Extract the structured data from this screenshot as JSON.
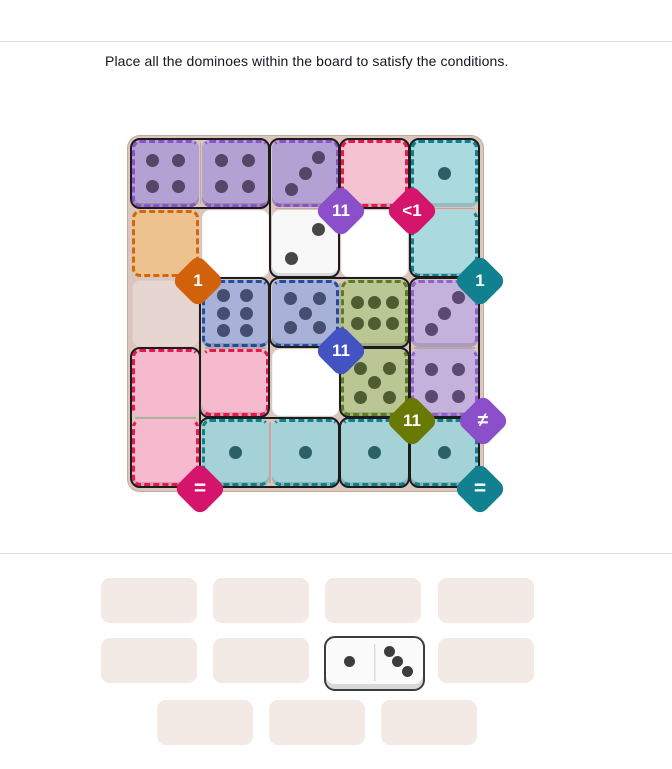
{
  "title": "Place all the dominoes within the board to satisfy the conditions.",
  "board": {
    "bg": "#dbc6bd",
    "metrics": {
      "off": 5,
      "pitch": 69.8,
      "size": 67
    },
    "cells": [
      {
        "id": "r1c1",
        "r": 1,
        "c": 1,
        "fill": "#b4a1d3",
        "pips": 4,
        "layout": "4",
        "pip": "#574568",
        "dash": "#8a52c8",
        "sides": "tlb",
        "lip": true
      },
      {
        "id": "r1c2",
        "r": 1,
        "c": 2,
        "fill": "#b4a1d3",
        "pips": 4,
        "layout": "4",
        "pip": "#574568",
        "dash": "#8a52c8",
        "sides": "tb",
        "lip": true
      },
      {
        "id": "r1c3",
        "r": 1,
        "c": 3,
        "fill": "#b4a1d3",
        "pips": 3,
        "layout": "3a",
        "pip": "#574568",
        "dash": "#8a52c8",
        "sides": "trb",
        "lip": true
      },
      {
        "id": "r1c4",
        "r": 1,
        "c": 4,
        "fill": "#f5c2d2",
        "pips": 0,
        "layout": "0",
        "pip": "",
        "dash": "#e8174f",
        "sides": "tlrb",
        "lip": true
      },
      {
        "id": "r1c5",
        "r": 1,
        "c": 5,
        "fill": "#aadade",
        "pips": 1,
        "layout": "1",
        "pip": "#2b6066",
        "dash": "#107f8d",
        "sides": "tlr",
        "lip": true
      },
      {
        "id": "r2c1",
        "r": 2,
        "c": 1,
        "fill": "#eec28f",
        "pips": 0,
        "layout": "0",
        "pip": "",
        "dash": "#d2660b",
        "sides": "tlrb",
        "lip": false
      },
      {
        "id": "r2c2",
        "r": 2,
        "c": 2,
        "fill": "#ffffff",
        "pips": 0,
        "layout": "0",
        "pip": "",
        "dash": null,
        "sides": "",
        "lip": false
      },
      {
        "id": "r2c3",
        "r": 2,
        "c": 3,
        "fill": "#f8f8f8",
        "pips": 2,
        "layout": "2",
        "pip": "#474747",
        "dash": null,
        "sides": "",
        "lip": true
      },
      {
        "id": "r2c4",
        "r": 2,
        "c": 4,
        "fill": "#ffffff",
        "pips": 0,
        "layout": "0",
        "pip": "",
        "dash": null,
        "sides": "",
        "lip": false
      },
      {
        "id": "r2c5",
        "r": 2,
        "c": 5,
        "fill": "#aadade",
        "pips": 0,
        "layout": "0",
        "pip": "",
        "dash": "#107f8d",
        "sides": "lrb",
        "lip": true
      },
      {
        "id": "r3c1",
        "r": 3,
        "c": 1,
        "fill": "#e6d5d1",
        "pips": 0,
        "layout": "0",
        "pip": "",
        "dash": null,
        "sides": "",
        "lip": false
      },
      {
        "id": "r3c2",
        "r": 3,
        "c": 2,
        "fill": "#a8b1d8",
        "pips": 6,
        "layout": "6v",
        "pip": "#434e70",
        "dash": "#1d4f9e",
        "sides": "tlb",
        "lip": true
      },
      {
        "id": "r3c3",
        "r": 3,
        "c": 3,
        "fill": "#a8b1d8",
        "pips": 5,
        "layout": "5",
        "pip": "#434e70",
        "dash": "#1d4f9e",
        "sides": "trb",
        "lip": true
      },
      {
        "id": "r3c4",
        "r": 3,
        "c": 4,
        "fill": "#bac795",
        "pips": 6,
        "layout": "6h",
        "pip": "#4e5d31",
        "dash": "#5d7c1d",
        "sides": "tlr",
        "lip": true
      },
      {
        "id": "r3c5",
        "r": 3,
        "c": 5,
        "fill": "#c4b2dd",
        "pips": 3,
        "layout": "3a",
        "pip": "#5c4870",
        "dash": "#9260cc",
        "sides": "tlr",
        "lip": true
      },
      {
        "id": "r4c1",
        "r": 4,
        "c": 1,
        "fill": "#f5bacd",
        "pips": 0,
        "layout": "0",
        "pip": "",
        "dash": "#e8174f",
        "sides": "tl",
        "lip": false
      },
      {
        "id": "r4c2",
        "r": 4,
        "c": 2,
        "fill": "#f5bacd",
        "pips": 0,
        "layout": "0",
        "pip": "",
        "dash": "#e8174f",
        "sides": "trb",
        "lip": true
      },
      {
        "id": "r4c3",
        "r": 4,
        "c": 3,
        "fill": "#ffffff",
        "pips": 0,
        "layout": "0",
        "pip": "",
        "dash": null,
        "sides": "",
        "lip": false
      },
      {
        "id": "r4c4",
        "r": 4,
        "c": 4,
        "fill": "#bac795",
        "pips": 5,
        "layout": "5",
        "pip": "#4e5d31",
        "dash": "#5d7c1d",
        "sides": "lrb",
        "lip": true
      },
      {
        "id": "r4c5",
        "r": 4,
        "c": 5,
        "fill": "#c4b2dd",
        "pips": 4,
        "layout": "4",
        "pip": "#5c4870",
        "dash": "#9260cc",
        "sides": "lrb",
        "lip": true
      },
      {
        "id": "r5c1",
        "r": 5,
        "c": 1,
        "fill": "#f5bacd",
        "pips": 0,
        "layout": "0",
        "pip": "",
        "dash": "#e8174f",
        "sides": "lrb",
        "lip": true
      },
      {
        "id": "r5c2",
        "r": 5,
        "c": 2,
        "fill": "#a4d2d7",
        "pips": 1,
        "layout": "1",
        "pip": "#2b6066",
        "dash": "#107f8d",
        "sides": "tlb",
        "lip": true
      },
      {
        "id": "r5c3",
        "r": 5,
        "c": 3,
        "fill": "#a4d2d7",
        "pips": 1,
        "layout": "1",
        "pip": "#2b6066",
        "dash": "#107f8d",
        "sides": "tb",
        "lip": true
      },
      {
        "id": "r5c4",
        "r": 5,
        "c": 4,
        "fill": "#a4d2d7",
        "pips": 1,
        "layout": "1",
        "pip": "#2b6066",
        "dash": "#107f8d",
        "sides": "tb",
        "lip": true
      },
      {
        "id": "r5c5",
        "r": 5,
        "c": 5,
        "fill": "#a4d2d7",
        "pips": 1,
        "layout": "1",
        "pip": "#2b6066",
        "dash": "#107f8d",
        "sides": "trb",
        "lip": true
      }
    ],
    "outlines": [
      {
        "r0": 1,
        "c0": 1,
        "r1": 1,
        "c1": 2,
        "div": "v"
      },
      {
        "r0": 1,
        "c0": 3,
        "r1": 2,
        "c1": 3,
        "div": "h"
      },
      {
        "r0": 1,
        "c0": 4,
        "r1": 1,
        "c1": 4,
        "div": null
      },
      {
        "r0": 1,
        "c0": 5,
        "r1": 2,
        "c1": 5,
        "div": "h"
      },
      {
        "r0": 3,
        "c0": 2,
        "r1": 4,
        "c1": 2,
        "div": "h"
      },
      {
        "r0": 3,
        "c0": 3,
        "r1": 3,
        "c1": 4,
        "div": "v"
      },
      {
        "r0": 3,
        "c0": 5,
        "r1": 4,
        "c1": 5,
        "div": "h"
      },
      {
        "r0": 4,
        "c0": 4,
        "r1": 4,
        "c1": 4,
        "div": null
      },
      {
        "r0": 4,
        "c0": 1,
        "r1": 5,
        "c1": 1,
        "div": "h"
      },
      {
        "r0": 5,
        "c0": 2,
        "r1": 5,
        "c1": 3,
        "div": "v"
      },
      {
        "r0": 5,
        "c0": 4,
        "r1": 5,
        "c1": 4,
        "div": null
      },
      {
        "r0": 5,
        "c0": 5,
        "r1": 5,
        "c1": 5,
        "div": null
      }
    ],
    "badges": [
      {
        "label": "11",
        "color": "#8b4fc9",
        "x": 214,
        "y": 76
      },
      {
        "label": "<1",
        "color": "#d4156b",
        "x": 285,
        "y": 76
      },
      {
        "label": "1",
        "color": "#d2610b",
        "x": 71,
        "y": 146
      },
      {
        "label": "1",
        "color": "#11808f",
        "x": 353,
        "y": 146
      },
      {
        "label": "11",
        "color": "#4353c2",
        "x": 214,
        "y": 216
      },
      {
        "label": "11",
        "color": "#697a04",
        "x": 285,
        "y": 286
      },
      {
        "label": "≠",
        "color": "#8b4fc9",
        "x": 356,
        "y": 286
      },
      {
        "label": "=",
        "color": "#d4156b",
        "x": 73,
        "y": 354
      },
      {
        "label": "=",
        "color": "#11808f",
        "x": 353,
        "y": 354
      }
    ]
  },
  "tray": {
    "slot_fill": "#f3eae6",
    "slot_w": 96,
    "slot_h": 45,
    "slots": [
      {
        "x": 101,
        "y": 578
      },
      {
        "x": 213,
        "y": 578
      },
      {
        "x": 325,
        "y": 578
      },
      {
        "x": 438,
        "y": 578
      },
      {
        "x": 101,
        "y": 638
      },
      {
        "x": 213,
        "y": 638
      },
      {
        "x": 438,
        "y": 638
      },
      {
        "x": 157,
        "y": 700
      },
      {
        "x": 269,
        "y": 700
      },
      {
        "x": 381,
        "y": 700
      }
    ],
    "domino": {
      "x": 324,
      "y": 636,
      "w": 97,
      "h": 51,
      "halves": [
        "1",
        "3b"
      ],
      "pip": "#3d3d3d"
    }
  }
}
